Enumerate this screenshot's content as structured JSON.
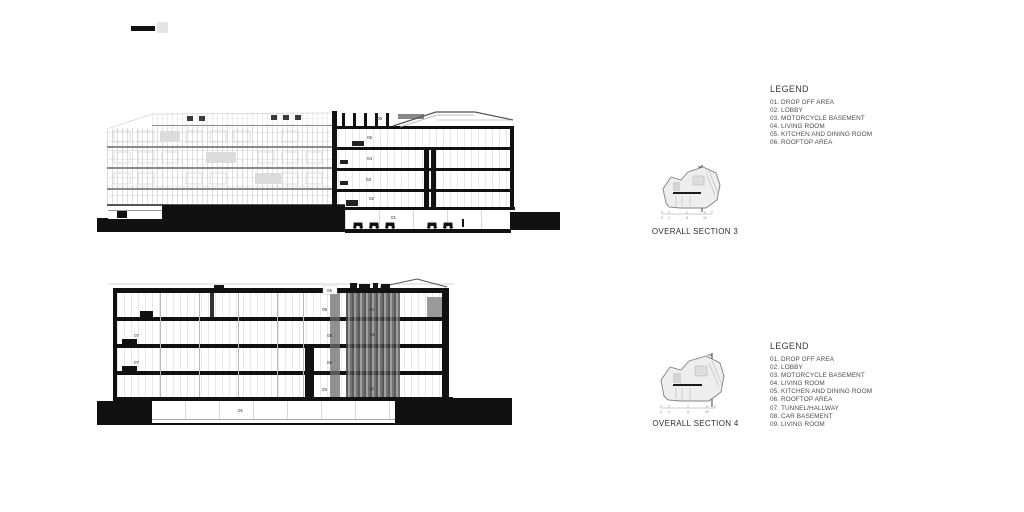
{
  "sections": {
    "section3": {
      "caption": "OVERALL SECTION 3",
      "room_labels": {
        "r01": "01",
        "r02": "02",
        "r03": "03",
        "r04": "04",
        "r05": "05",
        "r06": "06"
      },
      "scale_ticks": [
        "0",
        "1",
        "5",
        "10"
      ]
    },
    "section4": {
      "caption": "OVERALL SECTION 4",
      "room_labels": {
        "roof": "06",
        "left_top": "09",
        "right_top": "04",
        "left_mid": "08",
        "right_mid": "05",
        "left_lower": "06",
        "tunnel_upper": "07",
        "tunnel_lower": "07",
        "left_ground": "03",
        "right_ground": "02",
        "basement": "01"
      },
      "scale_ticks": [
        "0",
        "1",
        "5",
        "10"
      ]
    }
  },
  "legends": {
    "section3": {
      "title": "LEGEND",
      "items": [
        "01.  DROP OFF AREA",
        "02.  LOBBY",
        "03.  MOTORCYCLE BASEMENT",
        "04.  LIVING ROOM",
        "05.  KITCHEN AND DINING ROOM",
        "06.  ROOFTOP AREA"
      ]
    },
    "section4": {
      "title": "LEGEND",
      "items": [
        "01.  DROP OFF AREA",
        "02.  LOBBY",
        "03.  MOTORCYCLE BASEMENT",
        "04.  LIVING ROOM",
        "05.  KITCHEN AND DINING ROOM",
        "06.  ROOFTOP AREA",
        "07.  TUNNEL/HALLWAY",
        "08.  CAR BASEMENT",
        "09.  LIVING ROOM"
      ]
    }
  },
  "colors": {
    "ink": "#111111",
    "light_line": "#cccccc",
    "text": "#3c3c3c"
  }
}
